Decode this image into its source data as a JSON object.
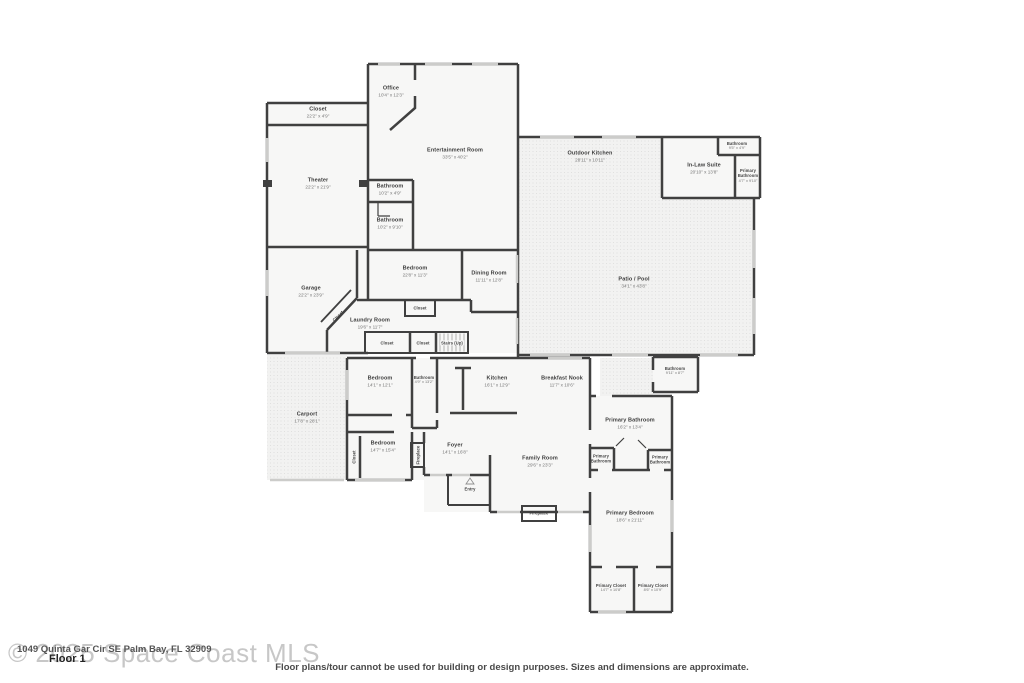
{
  "footer": {
    "watermark": "© 2025 Space Coast MLS",
    "address": "1049 Quinta Gar Cir SE Palm Bay, FL 32909",
    "floor_label": "Floor 1",
    "disclaimer": "Floor plans/tour cannot be used for building or design purposes. Sizes and dimensions are approximate."
  },
  "rooms": {
    "office": {
      "name": "Office",
      "dims": "10'4\" x 12'3\""
    },
    "closet_top": {
      "name": "Closet",
      "dims": "22'2\" x 4'9\""
    },
    "theater": {
      "name": "Theater",
      "dims": "22'2\" x 21'9\""
    },
    "entertainment": {
      "name": "Entertainment Room",
      "dims": "33'5\" x 40'2\""
    },
    "bath_upper_1": {
      "name": "Bathroom",
      "dims": "10'2\" x 4'9\""
    },
    "bath_upper_2": {
      "name": "Bathroom",
      "dims": "10'2\" x 9'10\""
    },
    "outdoor_kitchen": {
      "name": "Outdoor Kitchen",
      "dims": "28'11\" x 10'11\""
    },
    "bath_inlaw": {
      "name": "Bathroom",
      "dims": "9'5\" x 4'9\""
    },
    "inlaw_suite": {
      "name": "In-Law Suite",
      "dims": "20'10\" x 13'8\""
    },
    "primary_bath_inlaw": {
      "name": "Primary Bathroom",
      "dims": "4'7\" x 9'10\""
    },
    "patio_pool": {
      "name": "Patio / Pool",
      "dims": "34'1\" x 43'8\""
    },
    "garage": {
      "name": "Garage",
      "dims": "22'2\" x 23'9\""
    },
    "bedroom_mid": {
      "name": "Bedroom",
      "dims": "22'8\" x 11'3\""
    },
    "dining": {
      "name": "Dining Room",
      "dims": "11'11\" x 12'8\""
    },
    "closet_garage": {
      "name": "Closet",
      "dims": ""
    },
    "laundry": {
      "name": "Laundry Room",
      "dims": "19'6\" x 11'7\""
    },
    "closet_mid": {
      "name": "Closet",
      "dims": ""
    },
    "closet_hall_a": {
      "name": "Closet",
      "dims": ""
    },
    "closet_hall_b": {
      "name": "Closet",
      "dims": ""
    },
    "stairs": {
      "name": "Stairs (Up)",
      "dims": ""
    },
    "carport": {
      "name": "Carport",
      "dims": "17'8\" x 28'1\""
    },
    "bedroom_nw": {
      "name": "Bedroom",
      "dims": "14'1\" x 12'1\""
    },
    "bath_hall": {
      "name": "Bathroom",
      "dims": "4'9\" x 13'2\""
    },
    "kitchen": {
      "name": "Kitchen",
      "dims": "16'1\" x 12'9\""
    },
    "breakfast": {
      "name": "Breakfast Nook",
      "dims": "11'7\" x 10'6\""
    },
    "bedroom_sw": {
      "name": "Bedroom",
      "dims": "14'7\" x 15'4\""
    },
    "closet_sw": {
      "name": "Closet",
      "dims": ""
    },
    "fireplace_foyer": {
      "name": "Fireplace",
      "dims": ""
    },
    "foyer": {
      "name": "Foyer",
      "dims": "14'1\" x 16'8\""
    },
    "family": {
      "name": "Family Room",
      "dims": "29'6\" x 23'3\""
    },
    "entry": {
      "name": "Entry",
      "dims": ""
    },
    "fireplace_family": {
      "name": "Fireplace",
      "dims": ""
    },
    "bath_se": {
      "name": "Bathroom",
      "dims": "9'11\" x 8'7\""
    },
    "primary_bath": {
      "name": "Primary Bathroom",
      "dims": "16'2\" x 13'4\""
    },
    "primary_bath_wc1": {
      "name": "Primary Bathroom",
      "dims": ""
    },
    "primary_bath_wc2": {
      "name": "Primary Bathroom",
      "dims": ""
    },
    "primary_bedroom": {
      "name": "Primary Bedroom",
      "dims": "18'6\" x 21'11\""
    },
    "primary_closet_1": {
      "name": "Primary Closet",
      "dims": "14'7\" x 10'8\""
    },
    "primary_closet_2": {
      "name": "Primary Closet",
      "dims": "8'6\" x 10'9\""
    }
  },
  "colors": {
    "wall": "#404040",
    "window": "#ccccca",
    "floor": "#f7f7f6",
    "outdoor": "#f2f2f1"
  }
}
